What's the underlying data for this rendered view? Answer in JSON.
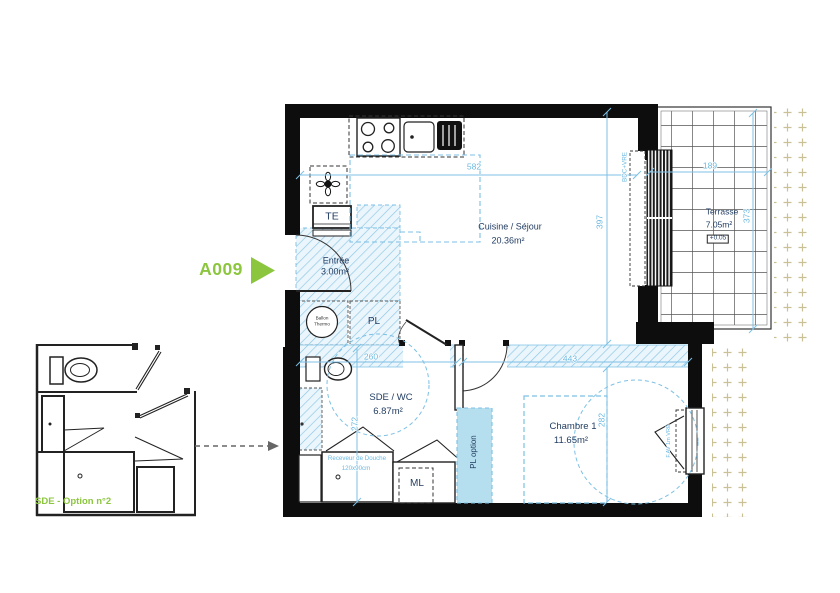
{
  "unit": {
    "label": "A009"
  },
  "option": {
    "label": "SDE - Option n°2"
  },
  "rooms": {
    "cuisine": {
      "name": "Cuisine / Séjour",
      "area": "20.36m²"
    },
    "entree": {
      "name": "Entrée",
      "area": "3.00m²"
    },
    "sde": {
      "name": "SDE / WC",
      "area": "6.87m²"
    },
    "chambre": {
      "name": "Chambre 1",
      "area": "11.65m²"
    },
    "terrasse": {
      "name": "Terrasse",
      "area": "7.05m²",
      "level": "+0.05"
    }
  },
  "fixtures": {
    "te": "TE",
    "pl": "PL",
    "ml": "ML",
    "pl_option": "PL option",
    "ballon_line1": "Ballon",
    "ballon_line2": "Thermo",
    "shower_line1": "Receveur de Douche",
    "shower_line2": "120x90cm"
  },
  "windows": {
    "bay": "BDC+VRE",
    "bedroom": "F.AV 1m VRE"
  },
  "dimensions": {
    "d582": "582",
    "d397": "397",
    "d189": "189",
    "d373": "373",
    "d260": "260",
    "d443": "443",
    "d272": "272",
    "d282": "282"
  },
  "colors": {
    "accent_green": "#8CC63F",
    "plan_blue": "#7CC0E4",
    "dim_text_blue": "#6DB9E0",
    "label_navy": "#1F3A5F",
    "ground_beige": "#C9C096",
    "option_fill": "#B5DFEE"
  }
}
